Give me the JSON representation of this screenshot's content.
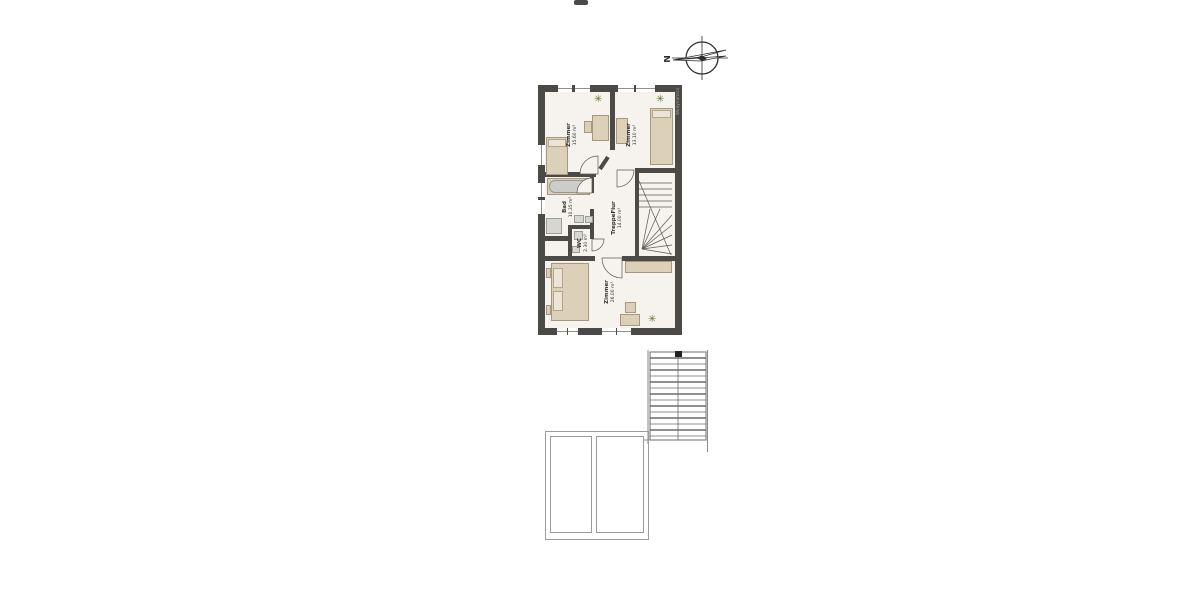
{
  "plan": {
    "rooms": [
      {
        "name": "Zimmer",
        "area": "15.60 m²"
      },
      {
        "name": "Zimmer",
        "area": "13.10 m²"
      },
      {
        "name": "Bad",
        "area": "10.35 m²"
      },
      {
        "name": "WC",
        "area": "2.30 m²"
      },
      {
        "name": "TreppeFlur",
        "area": "14.00 m²"
      },
      {
        "name": "Zimmer",
        "area": "26.00 m²"
      }
    ],
    "watermark": "Wodynamics"
  },
  "compass": {
    "north_label": "N"
  },
  "icons": {
    "plant_glyph": "✳"
  },
  "colors": {
    "wall": "#4b4a47",
    "floor": "#f6f2ed",
    "furniture": "#ddd0b9",
    "furniture_border": "#a6987e",
    "tub_grey": "#ccccc8",
    "plant_green": "#5d7a22",
    "thin_outline": "#9b9b9b",
    "line": "#555555"
  }
}
